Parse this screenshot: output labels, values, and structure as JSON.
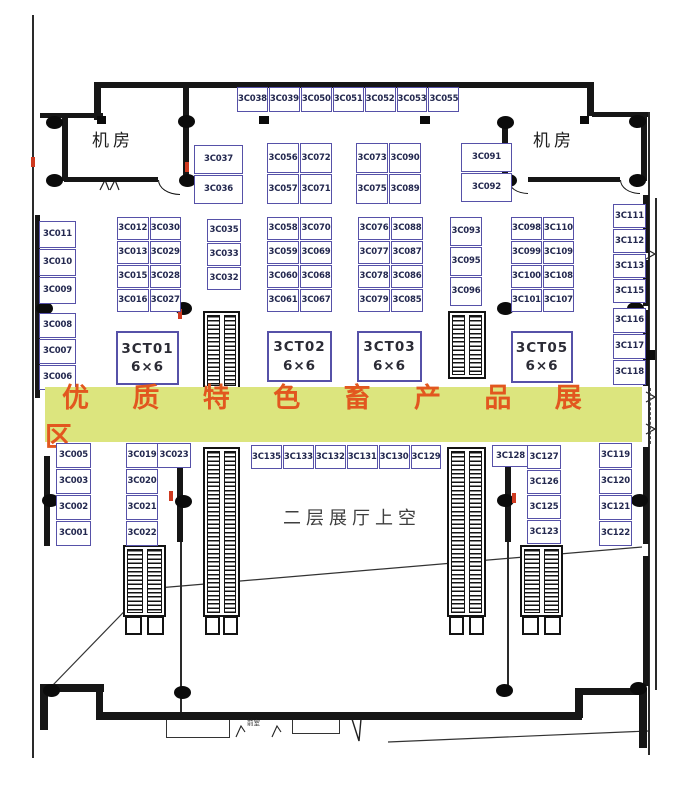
{
  "banner": {
    "text": "优 质 特 色 畜 产 品 展 区",
    "bg_color": "#dce57e",
    "text_color": "#e2571f"
  },
  "rooms": {
    "machine_left": "机房",
    "machine_right": "机房",
    "void_label": "二层展厅上空",
    "vestibule": "前室"
  },
  "tables": [
    {
      "id": "3CT01",
      "size": "6×6"
    },
    {
      "id": "3CT02",
      "size": "6×6"
    },
    {
      "id": "3CT03",
      "size": "6×6"
    },
    {
      "id": "3CT05",
      "size": "6×6"
    }
  ],
  "booths": {
    "top": [
      "3C038",
      "3C039",
      "3C050",
      "3C051",
      "3C052",
      "3C053",
      "3C055"
    ],
    "col_36": [
      "3C037",
      "3C036"
    ],
    "blk_56": [
      "3C056",
      "3C072",
      "3C057",
      "3C071"
    ],
    "blk_73": [
      "3C073",
      "3C090",
      "3C075",
      "3C089"
    ],
    "col_91": [
      "3C091",
      "3C092"
    ],
    "col_l_up": [
      "3C011",
      "3C010",
      "3C009"
    ],
    "col_l_low": [
      "3C008",
      "3C007",
      "3C006"
    ],
    "blk_12": [
      "3C012",
      "3C030",
      "3C013",
      "3C029",
      "3C015",
      "3C028",
      "3C016",
      "3C027"
    ],
    "col_35": [
      "3C035",
      "3C033",
      "3C032"
    ],
    "blk_58": [
      "3C058",
      "3C070",
      "3C059",
      "3C069",
      "3C060",
      "3C068",
      "3C061",
      "3C067"
    ],
    "blk_76": [
      "3C076",
      "3C088",
      "3C077",
      "3C087",
      "3C078",
      "3C086",
      "3C079",
      "3C085"
    ],
    "col_93": [
      "3C093",
      "3C095",
      "3C096"
    ],
    "blk_98": [
      "3C098",
      "3C110",
      "3C099",
      "3C109",
      "3C100",
      "3C108",
      "3C101",
      "3C107"
    ],
    "col_r_up": [
      "3C111",
      "3C112",
      "3C113",
      "3C115"
    ],
    "col_r_low": [
      "3C116",
      "3C117",
      "3C118"
    ],
    "col_05": [
      "3C005",
      "3C003",
      "3C002",
      "3C001"
    ],
    "col_19": [
      "3C019",
      "3C020",
      "3C021",
      "3C022"
    ],
    "cell_23": "3C023",
    "strip_low": [
      "3C135",
      "3C133",
      "3C132",
      "3C131",
      "3C130",
      "3C129"
    ],
    "cell_128": "3C128",
    "col_127": [
      "3C127",
      "3C126",
      "3C125",
      "3C123"
    ],
    "col_119": [
      "3C119",
      "3C120",
      "3C121",
      "3C122"
    ]
  },
  "colors": {
    "booth_border": "#5651a8",
    "wall": "#161616",
    "red_marker": "#cf3a20"
  }
}
